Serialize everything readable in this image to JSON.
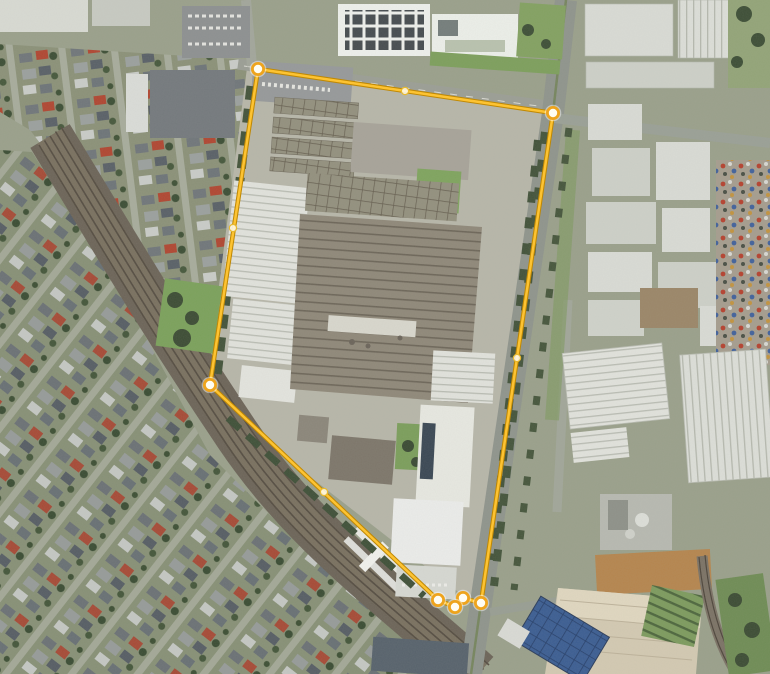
{
  "map": {
    "type": "satellite-imagery",
    "size_px": {
      "width": 770,
      "height": 674
    }
  },
  "boundary_overlay": {
    "line_color": "#fdc332",
    "line_outline_color": "#c08905",
    "vertex_fill": "#fffdf2",
    "vertex_ring_color": "#eea41d",
    "vertex_halo_color": "#ffffff",
    "midpoint_fill": "#fffdf2",
    "midpoint_ring_color": "#e7b92f",
    "vertices": [
      [
        258,
        69
      ],
      [
        553,
        113
      ],
      [
        481,
        603
      ],
      [
        463,
        598
      ],
      [
        455,
        607
      ],
      [
        438,
        600
      ],
      [
        210,
        385
      ]
    ],
    "midpoints": [
      [
        405,
        91
      ],
      [
        517,
        358
      ],
      [
        324,
        492
      ],
      [
        233,
        228
      ]
    ]
  }
}
